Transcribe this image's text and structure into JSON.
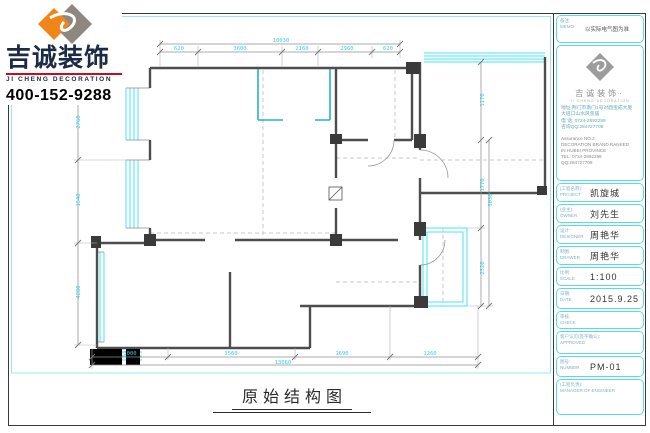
{
  "brand": {
    "name": "吉诚装饰",
    "name_en": "JI CHENG DECORATION",
    "phone": "400-152-9288"
  },
  "sheet_title": "原始结构图",
  "panel": {
    "memo": {
      "label_cn": "备注:",
      "label_en": "MEMO",
      "value": "以实际电气图为准"
    },
    "company": {
      "name": "吉诚装饰·",
      "tagline": "JI CHENG DECORATION",
      "address1": "地址:荆门市南门1号对面宝成大厦",
      "address2": "大道口山水风景居",
      "tel": "电 话: 0724-2892299",
      "qq": "咨询QQ:284727708",
      "assurance1": "Assurance NO.2",
      "assurance2": "DECORATION BRAND RANKED",
      "assurance3": "IN HUBEI PROVINCE",
      "tel2": "TEL: 0724-2892299",
      "qq2": "QQ:284727708"
    },
    "fields": [
      {
        "label_cn": "(工程名称):",
        "label_en": "PROJECT",
        "value": "凯旋城"
      },
      {
        "label_cn": "(业主):",
        "label_en": "OWNER",
        "value": "刘先生"
      },
      {
        "label_cn": "设计:",
        "label_en": "DESIGNER",
        "value": "周艳华"
      },
      {
        "label_cn": "制图:",
        "label_en": "DRAWER",
        "value": "周艳华"
      },
      {
        "label_cn": "比例:",
        "label_en": "SCALE",
        "value": "1:100"
      },
      {
        "label_cn": "日期:",
        "label_en": "DATE",
        "value": "2015.9.25"
      },
      {
        "label_cn": "审核:",
        "label_en": "CHECK",
        "value": ""
      },
      {
        "label_cn": "客户认可(签字确认):",
        "label_en": "APPROVED",
        "value": ""
      },
      {
        "label_cn": "图号:",
        "label_en": "NUMBER",
        "value": "PM-01"
      },
      {
        "label_cn": "(工程负责):",
        "label_en": "MANAGER OF ENGINEER",
        "value": ""
      }
    ]
  },
  "dimensions": {
    "top_total": "10030",
    "top_segments": [
      "620",
      "3600",
      "2160",
      "2960",
      "620"
    ],
    "bottom_total": "13660",
    "bottom_segments": [
      "1000",
      "3560",
      "1690",
      "1260"
    ],
    "left_segments": [
      "2760",
      "1540",
      "4280"
    ],
    "right_segments": [
      "1170",
      "1770",
      "2320"
    ],
    "right_total": "3030"
  },
  "colors": {
    "accent_cyan": "#4fd9ea",
    "window_cyan": "#45e6f5",
    "wall_gray": "#4d4d4d",
    "teal": "#1fb6c9",
    "brand_orange": "#f08519",
    "brand_navy": "#1c2b45",
    "brand_red": "#cc0a1d"
  }
}
